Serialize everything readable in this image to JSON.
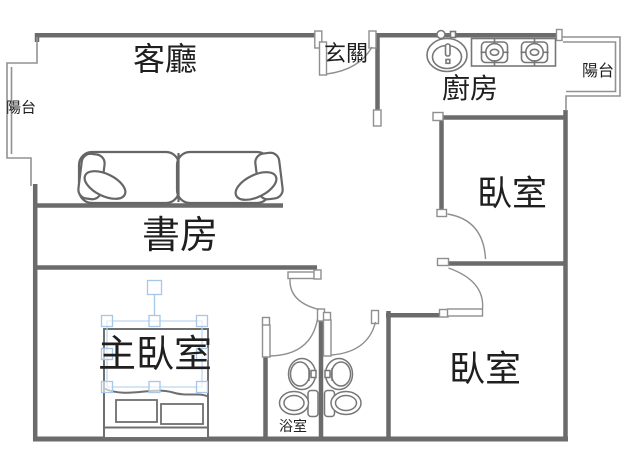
{
  "canvas": {
    "width": 640,
    "height": 462,
    "background": "#ffffff"
  },
  "colors": {
    "wall": "#6b6b6b",
    "thin_line": "#929292",
    "door_line": "#8f8f8f",
    "fixture_line": "#6f6f6f",
    "selection_accent": "#a5c7e9",
    "label_text": "#1f1f1f"
  },
  "rooms": {
    "living_room": {
      "label": "客廳"
    },
    "entryway": {
      "label": "玄關"
    },
    "kitchen": {
      "label": "廚房"
    },
    "balcony_left": {
      "label": "陽台"
    },
    "balcony_right": {
      "label": "陽台"
    },
    "study": {
      "label": "書房"
    },
    "bedroom_upper": {
      "label": "臥室"
    },
    "bedroom_lower": {
      "label": "臥室"
    },
    "master_bedroom": {
      "label": "主臥室"
    },
    "bathroom": {
      "label": "浴室"
    }
  },
  "icons": {
    "sofa": "sofa-top-view",
    "bed": "double-bed-top-view",
    "kitchen_sink": "kitchen-sink",
    "stove": "two-burner-gas-stove",
    "bathroom_sink_left": "pedestal-sink",
    "bathroom_sink_right": "pedestal-sink",
    "toilet_left": "toilet",
    "toilet_right": "toilet"
  }
}
